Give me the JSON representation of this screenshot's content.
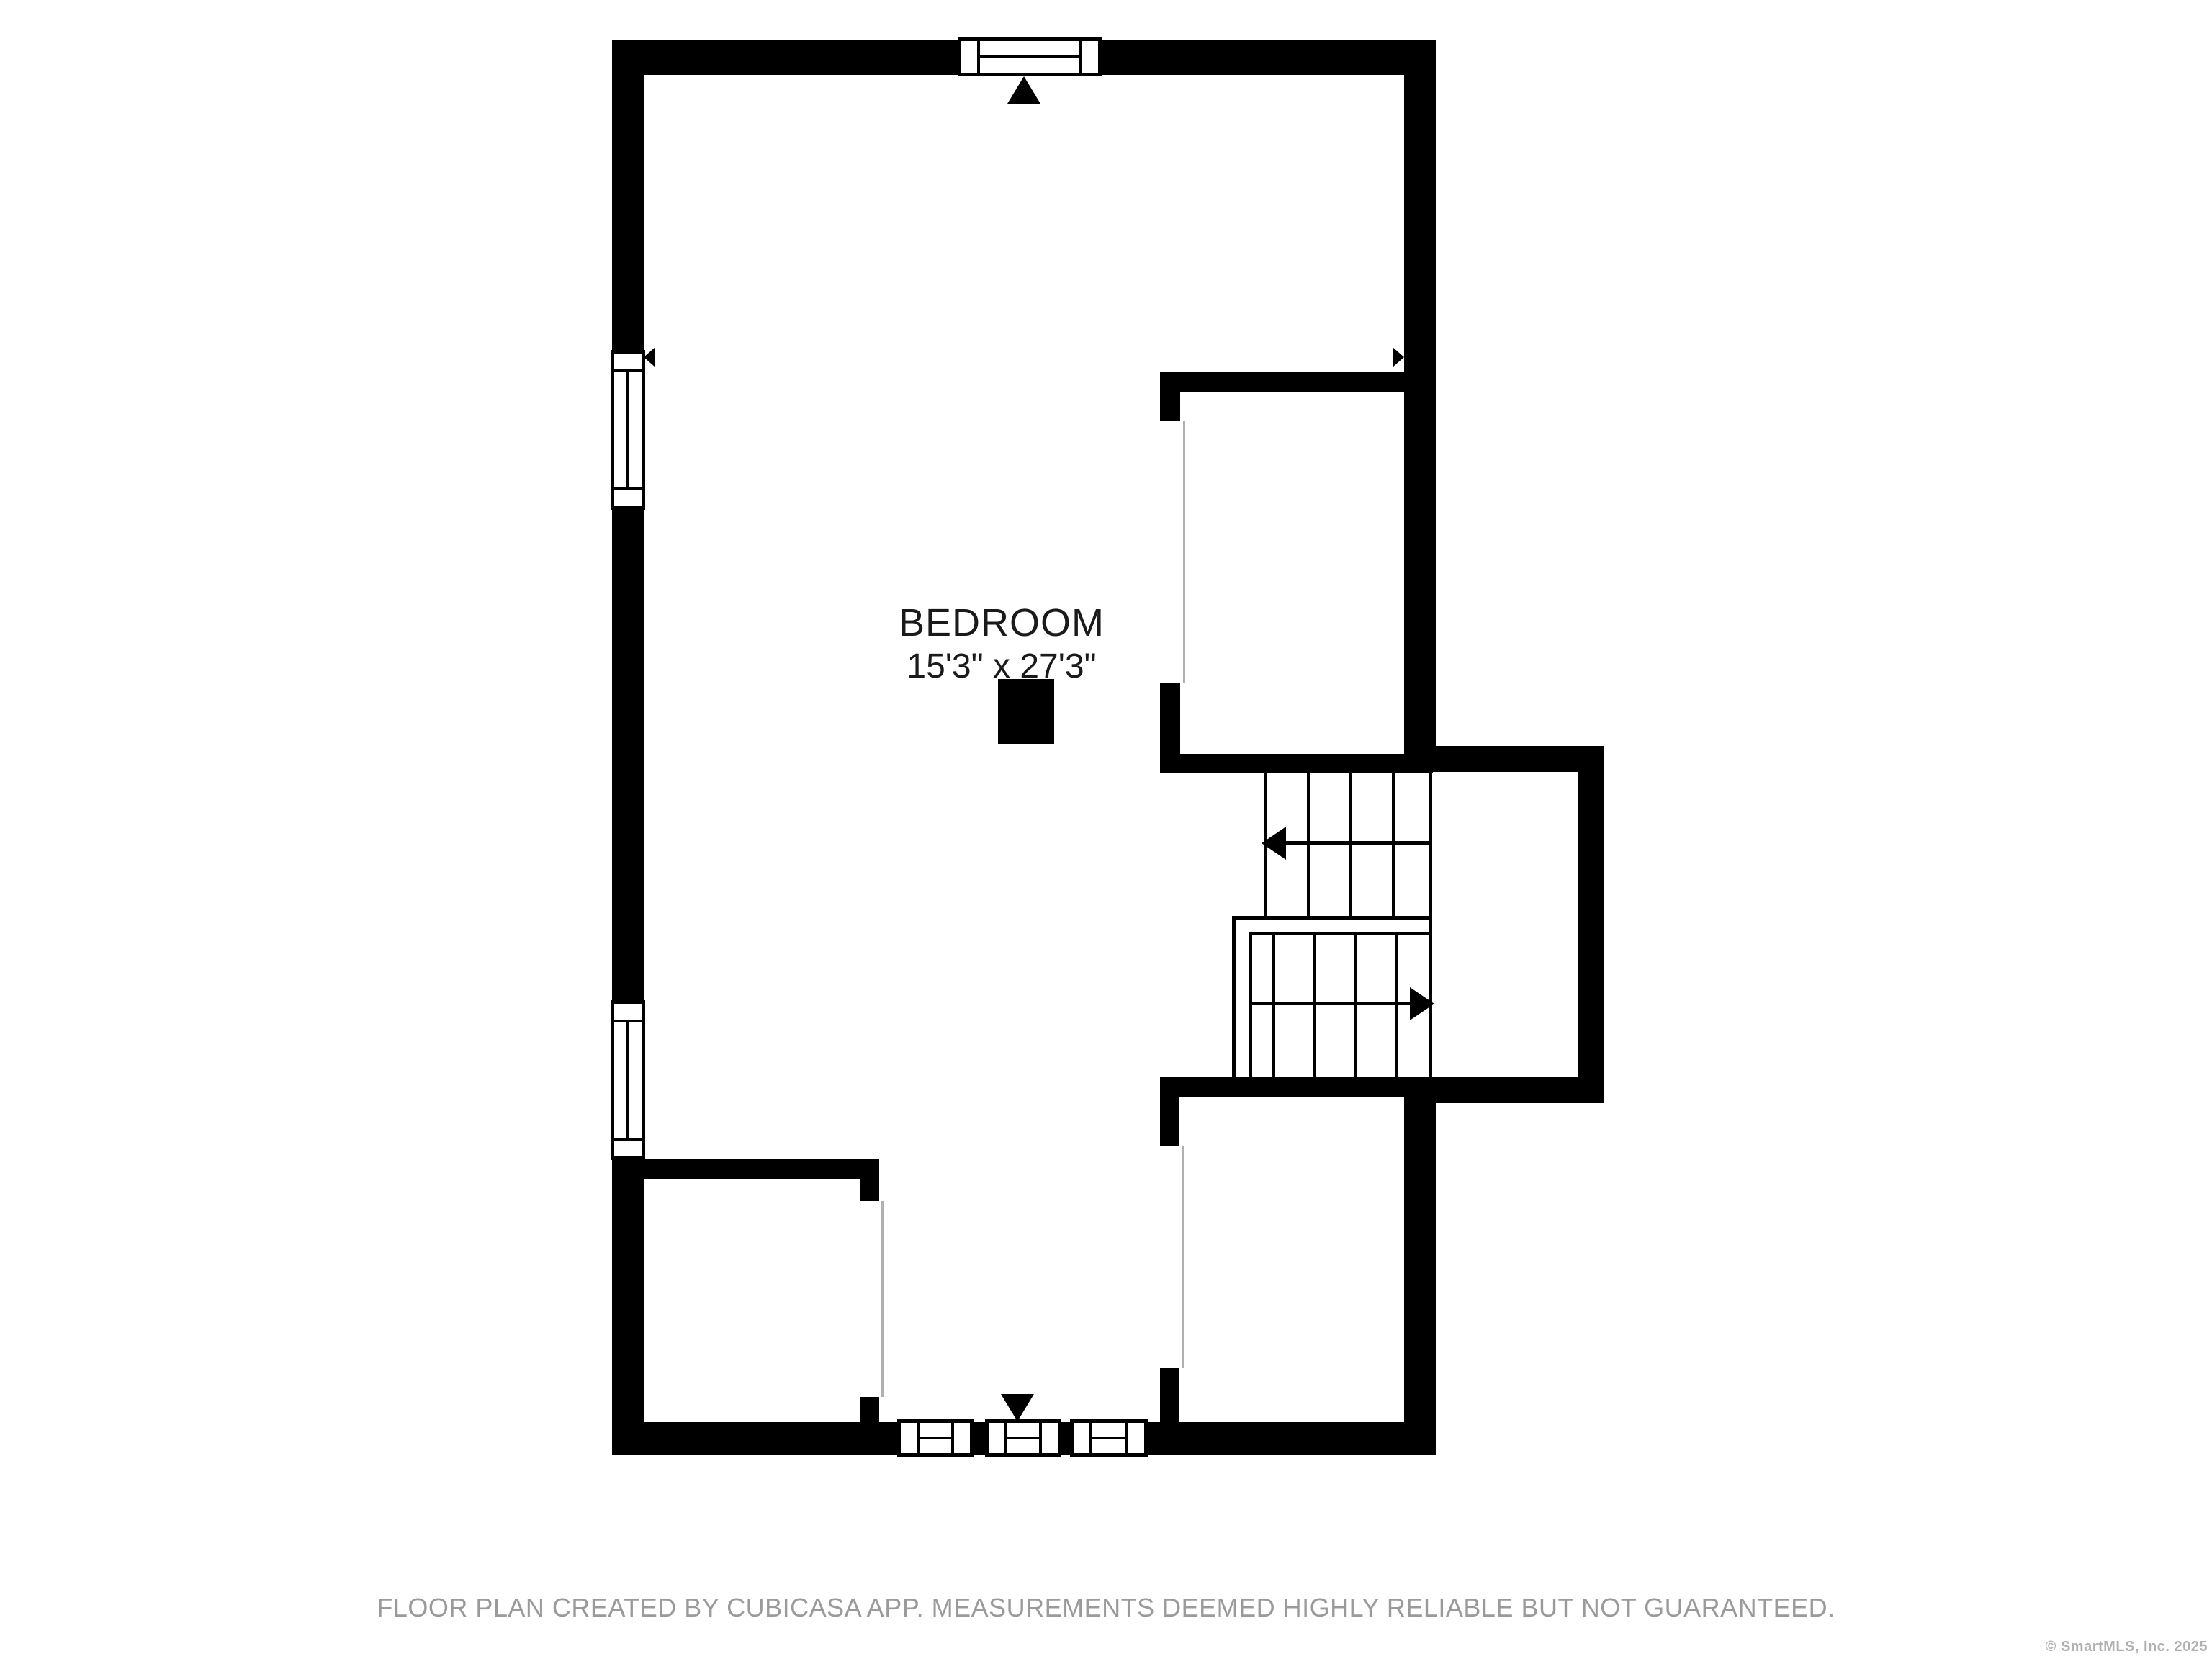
{
  "floor_plan": {
    "room": {
      "label": "BEDROOM",
      "dimensions": "15'3\" x 27'3\""
    },
    "features": {
      "windows": 6,
      "staircase": "u-shaped with up and down flights",
      "entrance_markers": 2
    },
    "colors": {
      "wall": "#000000",
      "background": "#ffffff",
      "door_jamb": "#b0b0b0",
      "disclaimer_text": "#9a9a9a",
      "copyright_text": "#b0b0b0"
    }
  },
  "footer": {
    "disclaimer": "FLOOR PLAN CREATED BY CUBICASA APP. MEASUREMENTS DEEMED HIGHLY RELIABLE BUT NOT GUARANTEED.",
    "copyright": "© SmartMLS, Inc.  2025"
  }
}
